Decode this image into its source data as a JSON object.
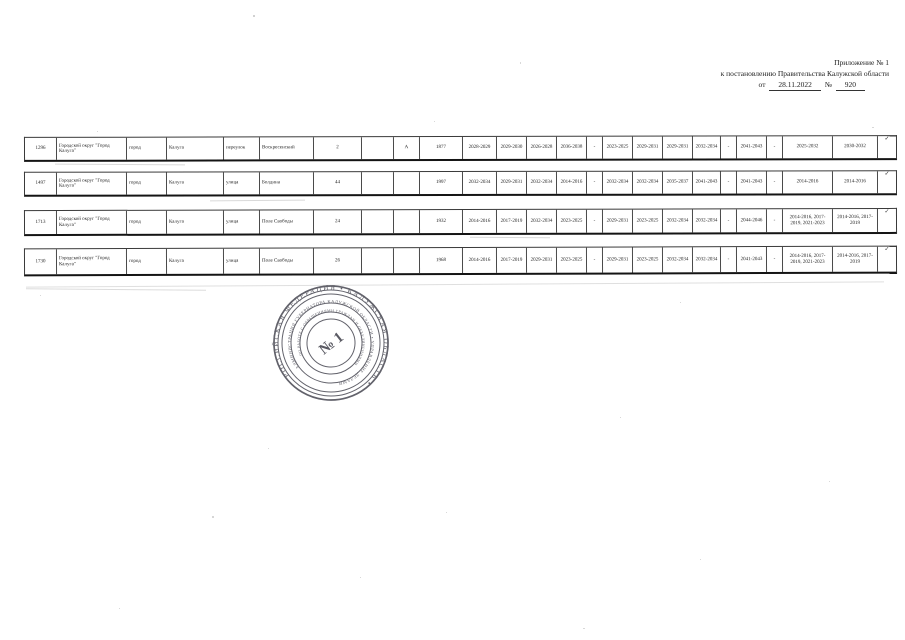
{
  "header": {
    "line1": "Приложение № 1",
    "line2": "к постановлению Правительства Калужской области",
    "from_label": "от",
    "date": "28.11.2022",
    "num_label": "№",
    "number": "920"
  },
  "table": {
    "rows": [
      {
        "num": "1296",
        "municipality": "Городской округ \"Город Калуга\"",
        "settlement_type": "город",
        "settlement": "Калуга",
        "street_type": "переулок",
        "street": "Воскресенский",
        "house": "2",
        "blank": "",
        "letter": "А",
        "built": "1877",
        "years": [
          "2028-2029",
          "2029-2030",
          "2026-2028",
          "2036-2038",
          "-",
          "2023-2025",
          "2029-2031",
          "2029-2031",
          "2032-2034",
          "-",
          "2041-2043",
          "-",
          "2025-2032",
          "2030-2032"
        ],
        "mark": "✓"
      },
      {
        "num": "1497",
        "municipality": "Городской округ \"Город Калуга\"",
        "settlement_type": "город",
        "settlement": "Калуга",
        "street_type": "улица",
        "street": "Болдина",
        "house": "44",
        "blank": "",
        "letter": "",
        "built": "1997",
        "years": [
          "2032-2034",
          "2029-2031",
          "2032-2034",
          "2014-2016",
          "-",
          "2032-2034",
          "2032-2034",
          "2035-2037",
          "2041-2043",
          "-",
          "2041-2043",
          "-",
          "2014-2016",
          "2014-2016"
        ],
        "mark": "✓"
      },
      {
        "num": "1713",
        "municipality": "Городской округ \"Город Калуга\"",
        "settlement_type": "город",
        "settlement": "Калуга",
        "street_type": "улица",
        "street": "Поле Свободы",
        "house": "24",
        "blank": "",
        "letter": "",
        "built": "1932",
        "years": [
          "2014-2016",
          "2017-2019",
          "2032-2034",
          "2023-2025",
          "-",
          "2029-2031",
          "2023-2025",
          "2032-2034",
          "2032-2034",
          "-",
          "2044-2046",
          "-",
          "2014-2016, 2017-2019, 2021-2023",
          "2014-2016, 2017-2019"
        ],
        "mark": "✓"
      },
      {
        "num": "1730",
        "municipality": "Городской округ \"Город Калуга\"",
        "settlement_type": "город",
        "settlement": "Калуга",
        "street_type": "улица",
        "street": "Поле Свободы",
        "house": "26",
        "blank": "",
        "letter": "",
        "built": "1968",
        "years": [
          "2014-2016",
          "2017-2019",
          "2029-2031",
          "2023-2025",
          "-",
          "2029-2031",
          "2023-2025",
          "2032-2034",
          "2032-2034",
          "-",
          "2041-2043",
          "-",
          "2014-2016, 2017-2019, 2021-2023",
          "2014-2016, 2017-2019"
        ],
        "mark": "✓"
      }
    ]
  },
  "stamp": {
    "outer_text": "РОССИЙСКАЯ ФЕДЕРАЦИЯ • КАЛУЖСКАЯ ОБЛАСТЬ •",
    "middle_text": "АДМИНИСТРАЦИЯ ГУБЕРНАТОРА КАЛУЖСКОЙ ОБЛАСТИ • УПРАВЛЕНИЕ ДЕЛАМИ",
    "inner_text": "ПО РАБОТЕ С ОБРАЩЕНИЯМИ ГРАЖДАН И ОБЪЕДИНЕНИЯМИ",
    "center_text": "№ 1",
    "color": "#4d4d57"
  }
}
